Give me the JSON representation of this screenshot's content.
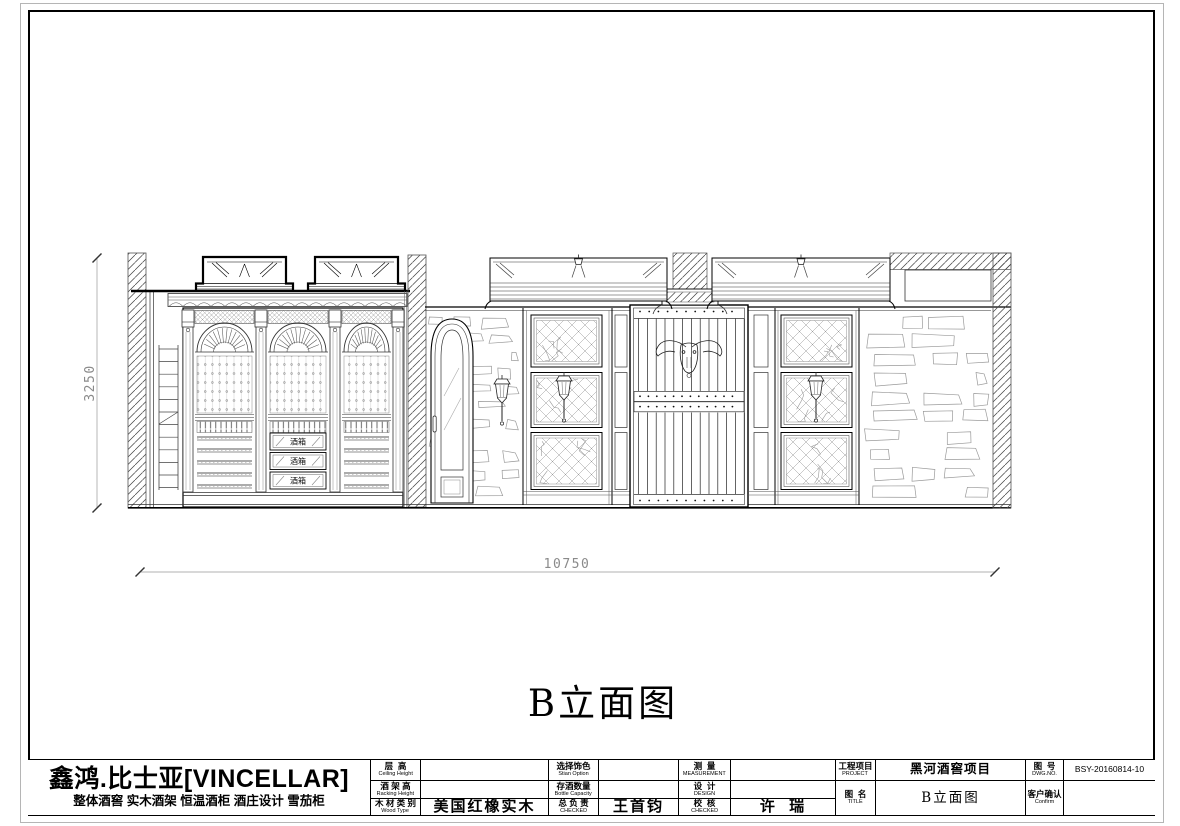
{
  "drawing": {
    "title": "B立面图",
    "dim_width": "10750",
    "dim_height": "3250",
    "drawers": [
      "酒箱",
      "酒箱",
      "酒箱"
    ]
  },
  "title_block": {
    "company": {
      "name": "鑫鸿.比士亚[VINCELLAR]",
      "tagline": "整体酒窖 实木酒架 恒温酒柜 酒庄设计 雪茄柜"
    },
    "ceiling": {
      "cn": "层  高",
      "en": "Ceiling Height",
      "value": ""
    },
    "racking": {
      "cn": "酒 架 高",
      "en": "Racking Height",
      "value": ""
    },
    "wood": {
      "cn": "木 材 类 别",
      "en": "Wood Type",
      "value": "美国红橡实木"
    },
    "stain": {
      "cn": "选择饰色",
      "en": "Stian Option",
      "value": ""
    },
    "capacity": {
      "cn": "存酒数量",
      "en": "Bottle Capacity",
      "value": ""
    },
    "chief": {
      "cn": "总 负 责",
      "en": "CHECKED",
      "value": "王首钧"
    },
    "measure": {
      "cn": "测  量",
      "en": "MEASUREMENT",
      "value": ""
    },
    "design": {
      "cn": "设  计",
      "en": "DESIGN",
      "value": ""
    },
    "check": {
      "cn": "校  核",
      "en": "CHECKED",
      "value": "许  瑞"
    },
    "project": {
      "cn": "工程项目",
      "en": "PROJECT",
      "value": "黑河酒窖项目"
    },
    "dwg_title": {
      "cn": "图  名",
      "en": "TITLE",
      "value": "B立面图"
    },
    "dwg_no": {
      "cn": "图  号",
      "en": "DWG.NO.",
      "value": "BSY-20160814-10"
    },
    "confirm": {
      "cn": "客户确认",
      "en": "Confirm",
      "value": ""
    }
  },
  "colors": {
    "line": "#000000",
    "dim": "#8a8a8a",
    "stone": "#9a9a9a"
  }
}
